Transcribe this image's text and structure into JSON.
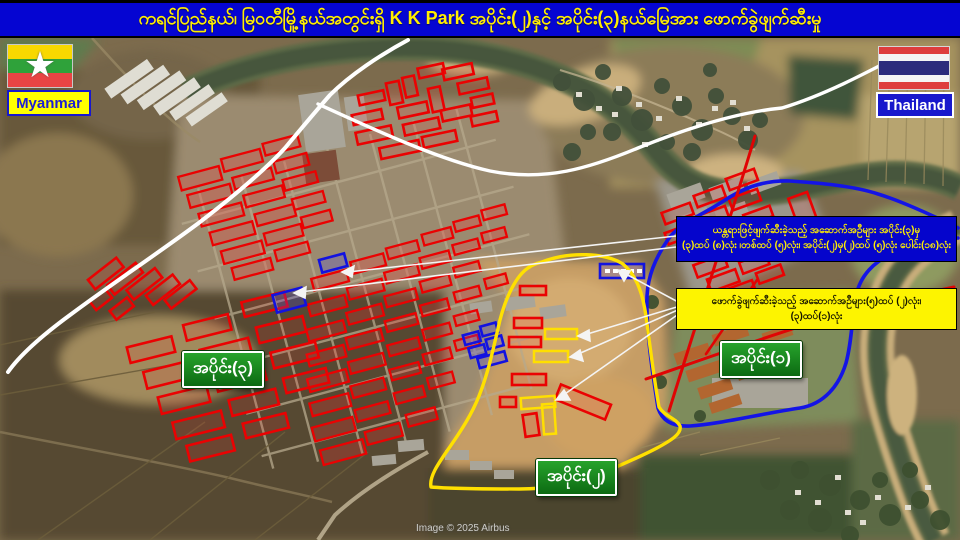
{
  "title_bar": {
    "text": "ကရင်ပြည်နယ်၊ မြဝတီမြို့နယ်အတွင်းရှိ K K Park အပိုင်း(၂)နှင့် အပိုင်း(၃)နယ်မြေအား ဖောက်ခွဲဖျက်ဆီးမှု"
  },
  "legend": {
    "myanmar_label": "Myanmar",
    "thailand_label": "Thailand"
  },
  "sections": {
    "part1": "အပိုင်း(၁)",
    "part2": "အပိုင်း(၂)",
    "part3": "အပိုင်း(၃)"
  },
  "callouts": {
    "machinery": {
      "line1": "ယန္တရားဖြင့်ဖျက်ဆီးခဲ့သည့် အဆောက်အဦများ အပိုင်း(၃)မှ",
      "line2": "(၃)ထပ် (၈)လုံး ၊တစ်ထပ် (၅)လုံး၊ အပိုင်း(၂)မှ(၂)ထပ် (၅)လုံး ပေါင်း(၁၈)လုံး"
    },
    "explosive": {
      "line1": "ဖောက်ခွဲဖျက်ဆီးခဲ့သည့် အဆောက်အဦများ(၅)ထပ် (၂)လုံး၊",
      "line2": "(၃)ထပ်(၁)လုံး"
    }
  },
  "map": {
    "attribution": "Image © 2025 Airbus"
  },
  "colors": {
    "title_bg": "#0505d2",
    "title_text": "#ffee00",
    "section_label_bg": "#157a1b",
    "machinery_box_bg": "#0505cc",
    "machinery_box_text": "#ffee00",
    "explosive_box_bg": "#fdf400",
    "boundary_white": "#ffffff",
    "boundary_blue": "#1414e6",
    "boundary_yellow": "#ffe000",
    "demolition_line_red": "#e00404",
    "building_outline_red": "#ea0202",
    "building_outline_blue": "#1212e0",
    "building_outline_yellow": "#ffdf00"
  }
}
